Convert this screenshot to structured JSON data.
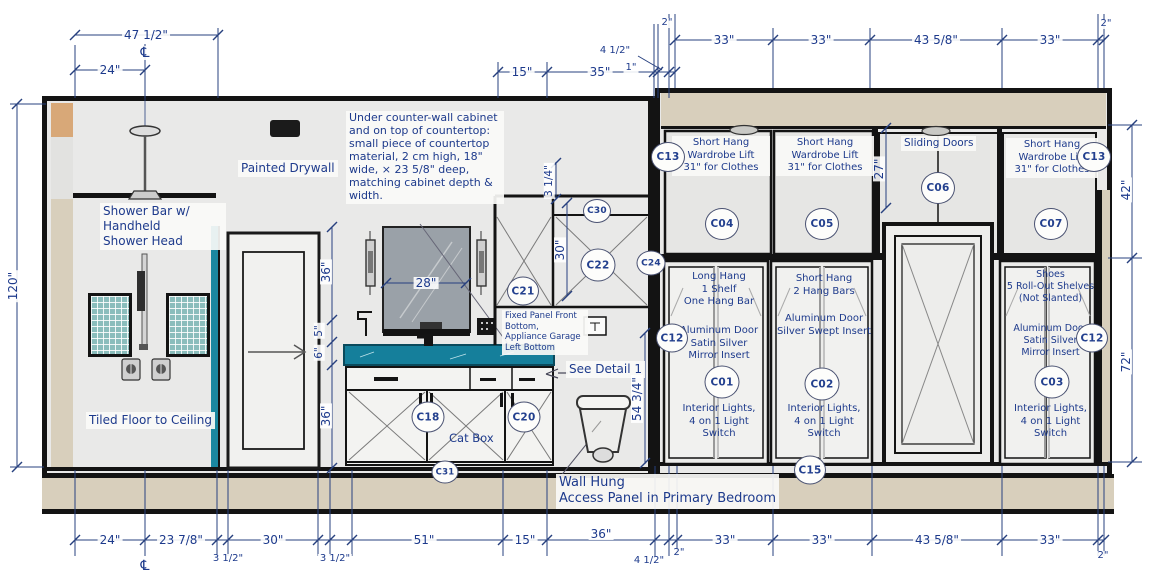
{
  "colors": {
    "dimension_line": "#27407f",
    "dimension_text": "#1d3a8c",
    "wall_black": "#131313",
    "wall_gray": "#e9e9e8",
    "floor_tan": "#d8cfbc",
    "corner_tan": "#d8a878",
    "counter_teal": "#157f9b",
    "tile_teal": "#8abdbc",
    "mirror_gray": "#9aa1a8"
  },
  "symbols": {
    "centerline": "℄"
  },
  "dims": {
    "top": {
      "d47_half": "47 1/2\"",
      "d24": "24\"",
      "d15": "15\"",
      "d35": "35\"",
      "d1": "1\"",
      "d4_half": "4 1/2\"",
      "d2_left": "2\"",
      "d33_1": "33\"",
      "d33_2": "33\"",
      "d43_58": "43 5/8\"",
      "d33_3": "33\"",
      "d2_right": "2\""
    },
    "bottom": {
      "d24": "24\"",
      "d23_78": "23 7/8\"",
      "d3_half_1": "3 1/2\"",
      "d30": "30\"",
      "d3_half_2": "3 1/2\"",
      "d51": "51\"",
      "d15": "15\"",
      "d36": "36\"",
      "d4_half": "4 1/2\"",
      "d2_mid": "2\"",
      "d33_1": "33\"",
      "d33_2": "33\"",
      "d43_58": "43 5/8\"",
      "d33_3": "33\"",
      "d2_right": "2\""
    },
    "side": {
      "left_height": "120\"",
      "right_upper": "42\"",
      "right_lower": "72\""
    },
    "interior": {
      "mirror_width": "28\"",
      "shower_36_upper": "36\"",
      "gap_5": "5\"",
      "counter_6": "6\"",
      "cabinet_36_lower": "36\"",
      "d3_quarter": "3 1/4\"",
      "d30_vert": "30\"",
      "d54_34": "54 3/4\"",
      "closet_27": "27\""
    }
  },
  "callouts": {
    "c13_left": "C13",
    "c04": "C04",
    "c05": "C05",
    "c06": "C06",
    "c07": "C07",
    "c13_right": "C13",
    "c30": "C30",
    "c21": "C21",
    "c22": "C22",
    "c24": "C24",
    "c18": "C18",
    "c20": "C20",
    "c31": "C31",
    "c12_left": "C12",
    "c01": "C01",
    "c02": "C02",
    "c03": "C03",
    "c12_right": "C12",
    "c15": "C15"
  },
  "labels": {
    "shower": "Shower Bar w/\nHandheld\nShower Head",
    "painted_drywall": "Painted Drywall",
    "tiled_floor": "Tiled Floor to Ceiling",
    "counter_note": "Under counter-wall cabinet\nand on top of countertop:\nsmall piece of countertop\nmaterial, 2 cm high, 18\"\nwide, × 23 5/8\" deep,\nmatching cabinet depth &\nwidth.",
    "fixed_panel": "Fixed Panel Front\nBottom,\nAppliance Garage\nLeft Bottom",
    "see_detail": "See Detail 1",
    "cat_box": "Cat Box",
    "wall_hung": "Wall Hung\nAccess Panel in Primary Bedroom",
    "sliding_doors": "Sliding Doors",
    "short_hang_lift": "Short Hang\nWardrobe Lift\n31\" for Clothes",
    "long_hang": "Long Hang\n1 Shelf\nOne Hang Bar",
    "alum_satin": "Aluminum Door\nSatin Silver\nMirror Insert",
    "short_hang_2": "Short Hang\n2 Hang Bars",
    "alum_swept": "Aluminum Door\nSilver Swept Insert",
    "shoes": "Shoes\n5 Roll-Out Shelves\n(Not Slanted)",
    "interior_lights": "Interior Lights,\n4 on 1 Light\nSwitch"
  }
}
